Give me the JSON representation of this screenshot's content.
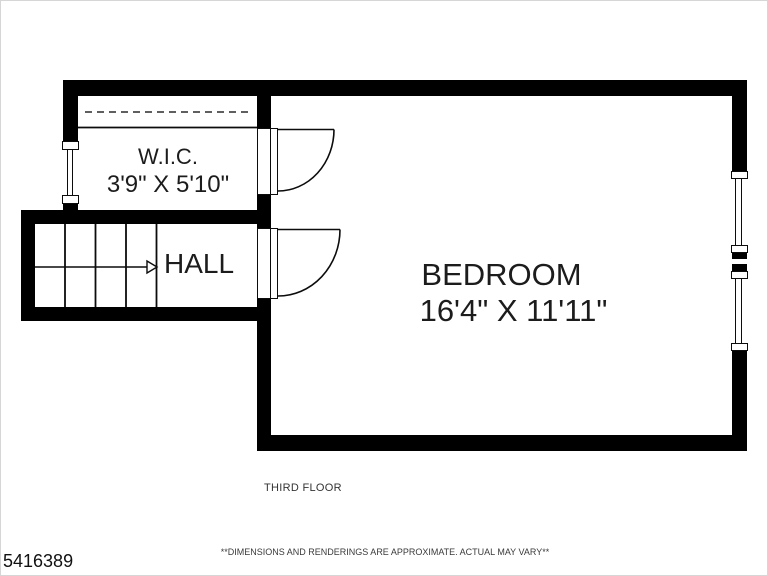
{
  "rooms": {
    "wic": {
      "name": "W.I.C.",
      "dims": "3'9\" X 5'10\""
    },
    "hall": {
      "name": "HALL"
    },
    "bedroom": {
      "name": "BEDROOM",
      "dims": "16'4\" X 11'11\""
    }
  },
  "floor": {
    "label": "THIRD FLOOR"
  },
  "disclaimer": "**DIMENSIONS AND RENDERINGS ARE APPROXIMATE. ACTUAL MAY VARY**",
  "listing_id": "5416389",
  "colors": {
    "wall": "#000000",
    "line": "#0c0c0c",
    "text": "#1c1c1c",
    "background": "#ffffff"
  }
}
